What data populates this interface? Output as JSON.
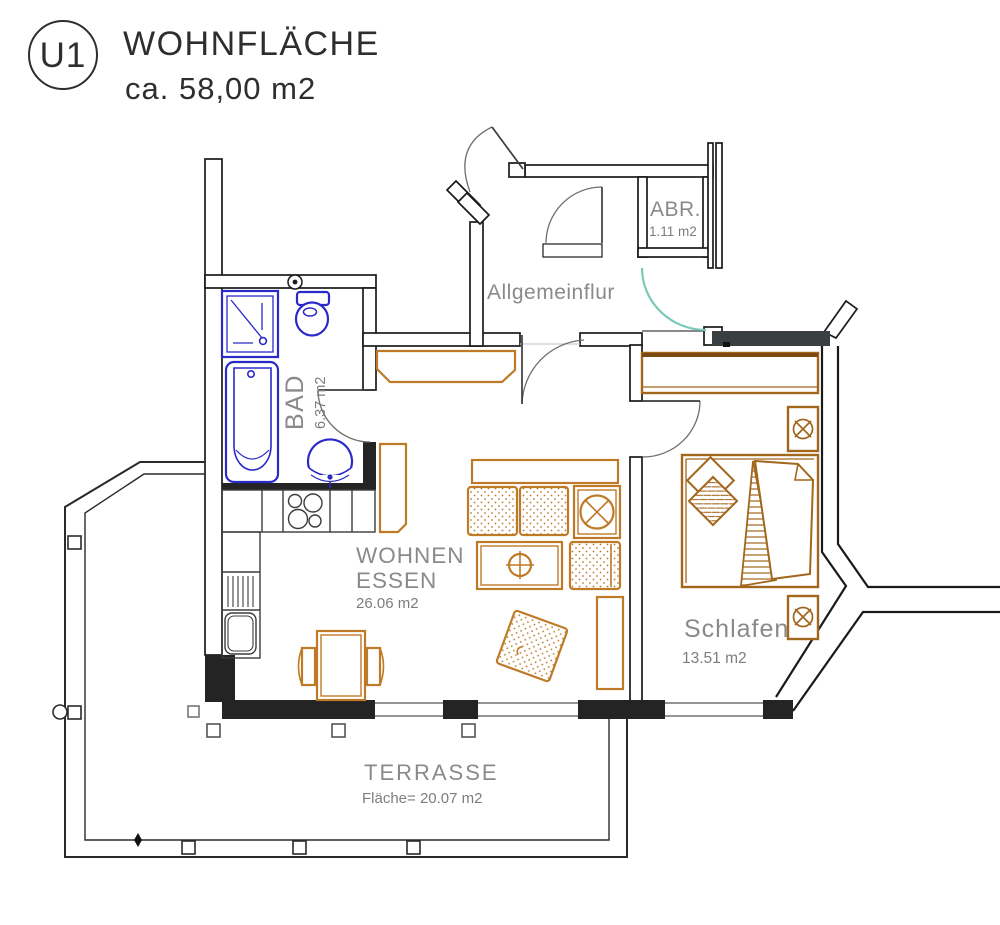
{
  "header": {
    "unit_badge": "U1",
    "title": "WOHNFLÄCHE",
    "subtitle": "ca.  58,00  m2"
  },
  "rooms": {
    "abr": {
      "name": "ABR.",
      "area": "1.11 m2"
    },
    "hall": {
      "name": "Allgemeinflur"
    },
    "bad": {
      "name": "BAD",
      "area": "6.37 m2"
    },
    "living": {
      "name_line1": "WOHNEN",
      "name_line2": "ESSEN",
      "area": "26.06 m2"
    },
    "bedroom": {
      "name": "Schlafen",
      "area": "13.51 m2"
    },
    "terrace": {
      "name": "TERRASSE",
      "area": "Fläche=  20.07  m2"
    }
  },
  "colors": {
    "wall": "#1a1a1a",
    "wall_dark_band": "#3a3f42",
    "fixture_blue": "#2a2ac8",
    "furniture_orange": "#bf7a28",
    "furniture_brown": "#a2661c",
    "label_gray": "#8a8a8a",
    "door_teal": "#7cc9ba"
  }
}
